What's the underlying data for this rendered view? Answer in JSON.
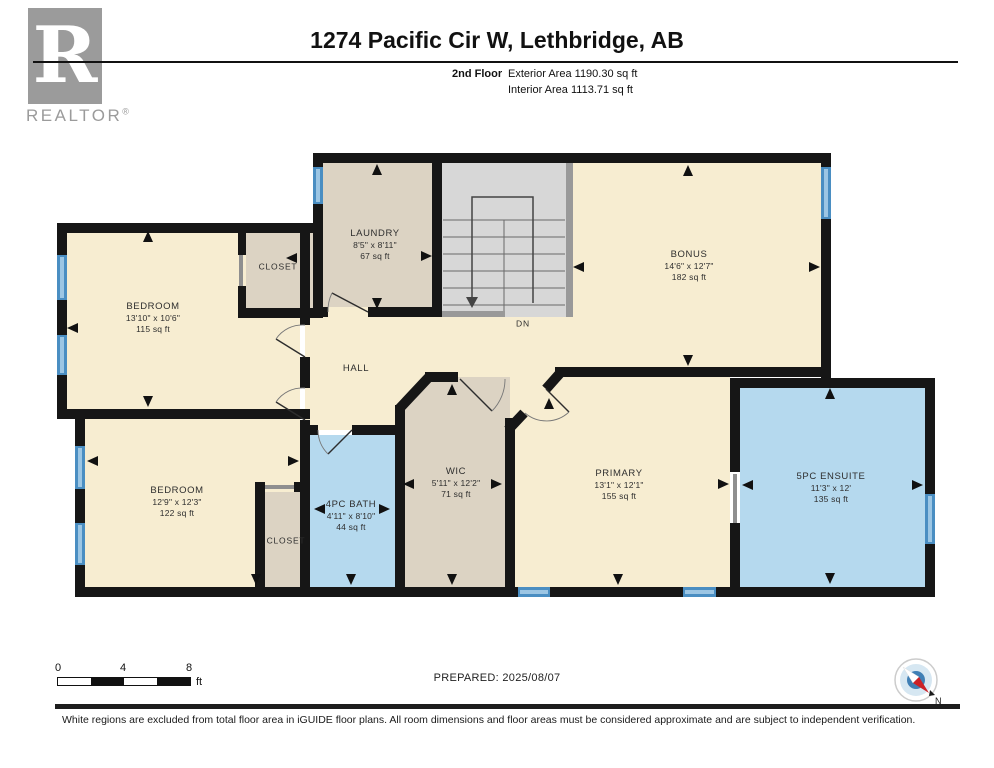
{
  "header": {
    "title": "1274 Pacific Cir W, Lethbridge, AB",
    "floor_label": "2nd Floor",
    "exterior_area": "Exterior Area 1190.30 sq ft",
    "interior_area": "Interior Area 1113.71 sq ft"
  },
  "logo": {
    "letter": "R",
    "text": "REALTOR",
    "registered": "®"
  },
  "rooms": {
    "bedroom1": {
      "name": "BEDROOM",
      "dims": "13'10\" x 10'6\"",
      "area": "115 sq ft"
    },
    "closet1": {
      "name": "CLOSET"
    },
    "laundry": {
      "name": "LAUNDRY",
      "dims": "8'5\" x 8'11\"",
      "area": "67 sq ft"
    },
    "bonus": {
      "name": "BONUS",
      "dims": "14'6\" x 12'7\"",
      "area": "182 sq ft"
    },
    "stairs": {
      "name": "DN"
    },
    "hall": {
      "name": "HALL"
    },
    "bedroom2": {
      "name": "BEDROOM",
      "dims": "12'9\" x 12'3\"",
      "area": "122 sq ft"
    },
    "closet2": {
      "name": "CLOSET"
    },
    "bath": {
      "name": "4PC BATH",
      "dims": "4'11\" x 8'10\"",
      "area": "44 sq ft"
    },
    "wic": {
      "name": "WIC",
      "dims": "5'11\" x 12'2\"",
      "area": "71 sq ft"
    },
    "primary": {
      "name": "PRIMARY",
      "dims": "13'1\" x 12'1\"",
      "area": "155 sq ft"
    },
    "ensuite": {
      "name": "5PC ENSUITE",
      "dims": "11'3\" x 12'",
      "area": "135 sq ft"
    }
  },
  "footer": {
    "scale": {
      "t0": "0",
      "t4": "4",
      "t8": "8",
      "unit": "ft"
    },
    "prepared": "PREPARED: 2025/08/07",
    "compass_north": "N",
    "disclaimer": "White regions are excluded from total floor area in iGUIDE floor plans. All room dimensions and floor areas must be considered approximate and are subject to independent verification."
  },
  "colors": {
    "room": "#f7edd1",
    "utility": "#dcd3c3",
    "bath": "#b5d9ee",
    "stairs": "#d7d7d7",
    "wall": "#161616",
    "window": "#4a8ec2",
    "window-inner": "#9cc6e4",
    "railing": "#999999"
  }
}
